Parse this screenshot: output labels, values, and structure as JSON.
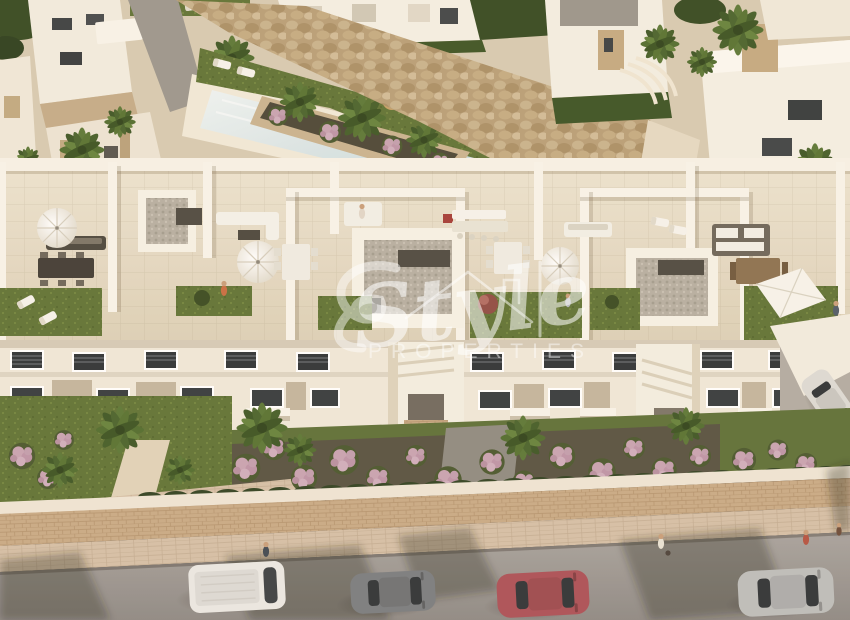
{
  "scene": {
    "type": "aerial-architectural-render",
    "description": "Aerial 3D render of a new-build white apartment complex with rooftop terraces, communal pool, rock garden, landscaped gardens and street parking in warm evening light",
    "watermark": {
      "script_word": "Style",
      "caps_word": "PROPERTIES",
      "color": "#ffffff"
    },
    "palette": {
      "building_white": "#f3eee3",
      "terrace_floor": "#e6dcc8",
      "grass_green": "#5e7133",
      "palm_green": "#4f6b2d",
      "flower_pink": "#c7a2b1",
      "pool_water": "#d8e6e9",
      "rock_tan": "#c0a77f",
      "road_gray": "#9b9591",
      "sidewalk_tan": "#d4bfa6",
      "window_dark": "#2d3134",
      "car_red": "#b5535a",
      "car_white": "#eae8e3",
      "car_gray": "#7f8285",
      "car_silver": "#c7c8c6"
    },
    "vehicles": [
      {
        "name": "white-van"
      },
      {
        "name": "dark-gray-hatchback"
      },
      {
        "name": "red-car"
      },
      {
        "name": "silver-car"
      },
      {
        "name": "white-car-driveway"
      }
    ],
    "features": [
      "swimming-pool",
      "rock-garden",
      "rooftop-terraces",
      "roof-lawns",
      "patio-umbrellas",
      "outdoor-dining-sets",
      "sun-loungers",
      "shade-sail",
      "palm-trees",
      "flowering-shrubs",
      "hedges",
      "retaining-wall",
      "sidewalk",
      "street",
      "pedestrians"
    ],
    "people_visible": 8
  }
}
